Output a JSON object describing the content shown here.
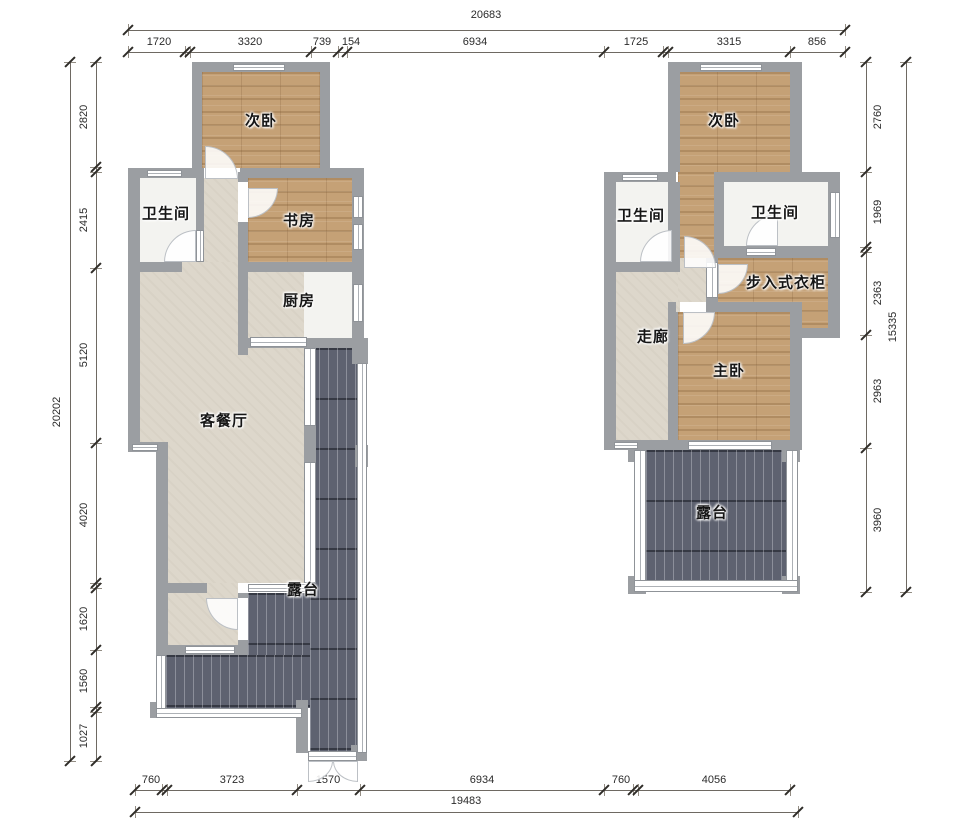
{
  "colors": {
    "wall": "#9b9ea2",
    "wood_floor": "#c5a176",
    "beige_floor": "#ddd7cb",
    "tile_floor": "#f3f3f0",
    "deck": "#5e6270",
    "dimension_text": "#2b2b2b",
    "background": "#ffffff"
  },
  "rooms": {
    "left_unit": {
      "bedroom2": "次卧",
      "bathroom": "卫生间",
      "study": "书房",
      "kitchen": "厨房",
      "living_dining": "客餐厅",
      "terrace": "露台"
    },
    "right_unit": {
      "bedroom2": "次卧",
      "bathroom1": "卫生间",
      "bathroom2": "卫生间",
      "walk_in_closet": "步入式衣柜",
      "corridor": "走廊",
      "master_bedroom": "主卧",
      "terrace": "露台"
    }
  },
  "dims": {
    "top": {
      "total": "20683",
      "segments": [
        "1720",
        "3320",
        "739",
        "154",
        "6934",
        "1725",
        "3315",
        "856"
      ]
    },
    "left": {
      "total": "20202",
      "segments": [
        "2820",
        "2415",
        "5120",
        "4020",
        "1620",
        "1560",
        "1027"
      ]
    },
    "right": {
      "total": "15335",
      "segments": [
        "2760",
        "1969",
        "2363",
        "2963",
        "3960"
      ]
    },
    "bottom": {
      "total": "19483",
      "segments": [
        "760",
        "3723",
        "1570",
        "6934",
        "760",
        "4056"
      ]
    }
  }
}
